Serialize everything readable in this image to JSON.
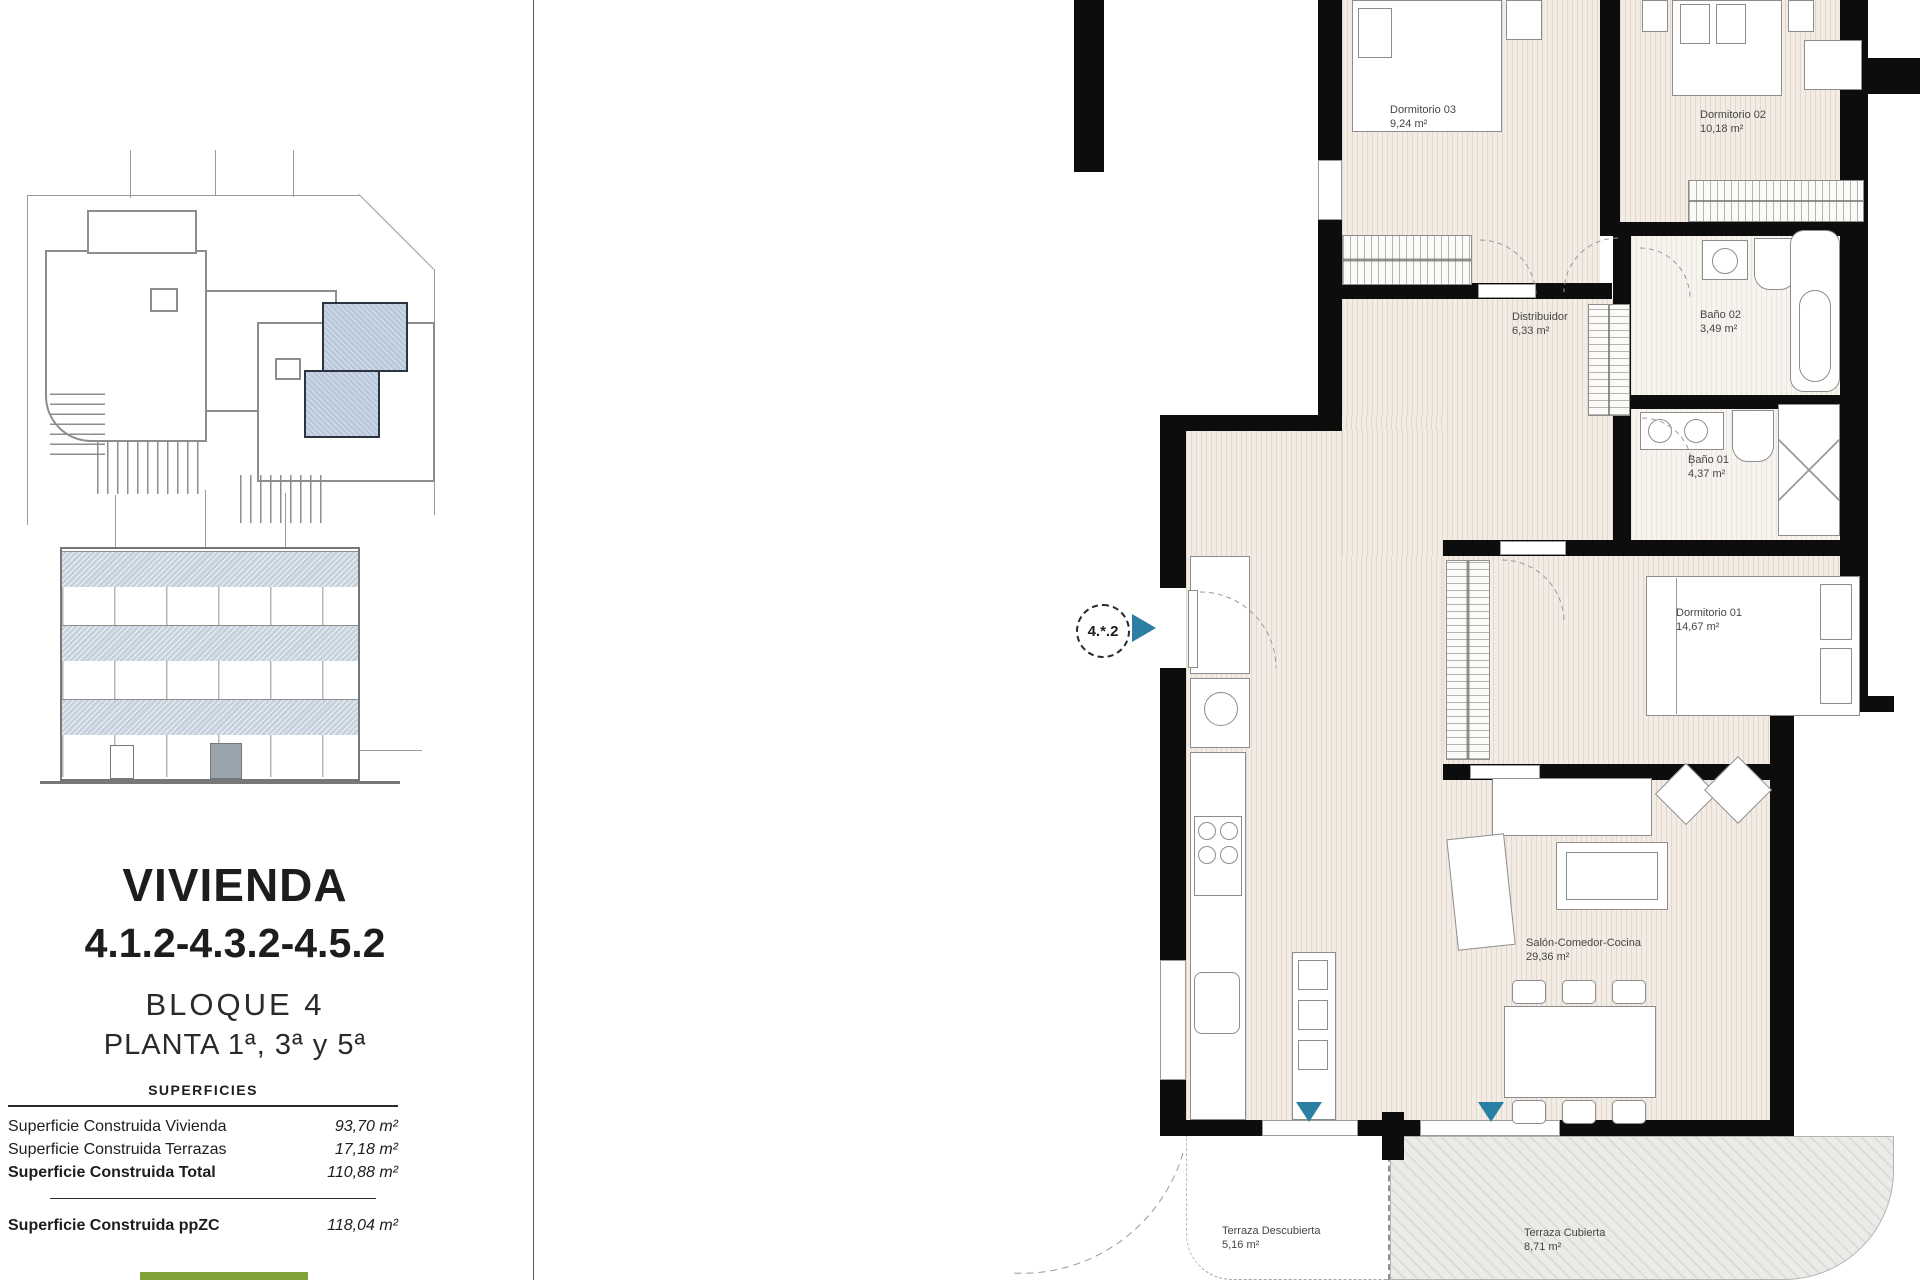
{
  "colors": {
    "accent_teal": "#2b7fa3",
    "unit_highlight": "#b9c9db",
    "wall": "#0d0d0d",
    "green_bar": "#7fa23b"
  },
  "left_panel": {
    "title": "VIVIENDA",
    "unit_numbers": "4.1.2-4.3.2-4.5.2",
    "block_label": "BLOQUE 4",
    "floors_label": "PLANTA 1ª, 3ª y 5ª",
    "superficies": {
      "header": "SUPERFICIES",
      "rows": [
        {
          "label": "Superficie Construida Vivienda",
          "value": "93,70 m²"
        },
        {
          "label": "Superficie Construida Terrazas",
          "value": "17,18 m²"
        },
        {
          "label": "Superficie Construida Total",
          "value": "110,88 m²"
        }
      ],
      "footer": {
        "label": "Superficie Construida ppZC",
        "value": "118,04 m²"
      }
    }
  },
  "floor_plan": {
    "unit_marker": "4.*.2",
    "rooms": [
      {
        "name": "Dormitorio 03",
        "area": "9,24 m²"
      },
      {
        "name": "Dormitorio 02",
        "area": "10,18 m²"
      },
      {
        "name": "Distribuidor",
        "area": "6,33 m²"
      },
      {
        "name": "Baño 02",
        "area": "3,49 m²"
      },
      {
        "name": "Baño 01",
        "area": "4,37 m²"
      },
      {
        "name": "Dormitorio 01",
        "area": "14,67 m²"
      },
      {
        "name": "Salón-Comedor-Cocina",
        "area": "29,36 m²"
      },
      {
        "name": "Terraza Descubierta",
        "area": "5,16 m²"
      },
      {
        "name": "Terraza Cubierta",
        "area": "8,71 m²"
      }
    ]
  }
}
